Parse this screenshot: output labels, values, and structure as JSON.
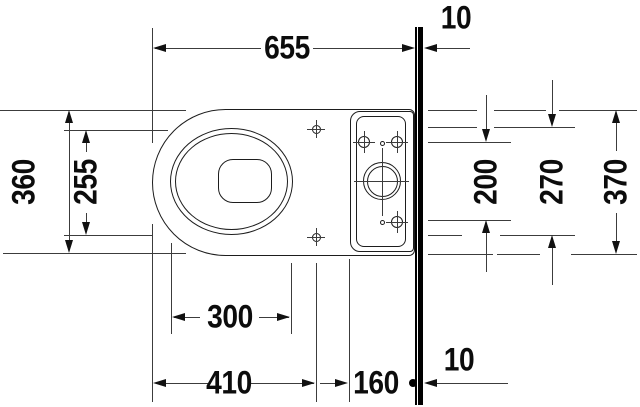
{
  "drawing": {
    "type": "toilet-plan-technical-drawing",
    "colors": {
      "background": "#ffffff",
      "outline": "#1d1d1d",
      "dimension_line": "#3c3c3c",
      "wall": "#000000",
      "text": "#0c0c0c"
    }
  },
  "dims": {
    "d655": "655",
    "d10_top": "10",
    "d360": "360",
    "d255": "255",
    "d300": "300",
    "d410": "410",
    "d160": "160",
    "d10_bottom": "10",
    "d200": "200",
    "d270": "270",
    "d370": "370"
  }
}
